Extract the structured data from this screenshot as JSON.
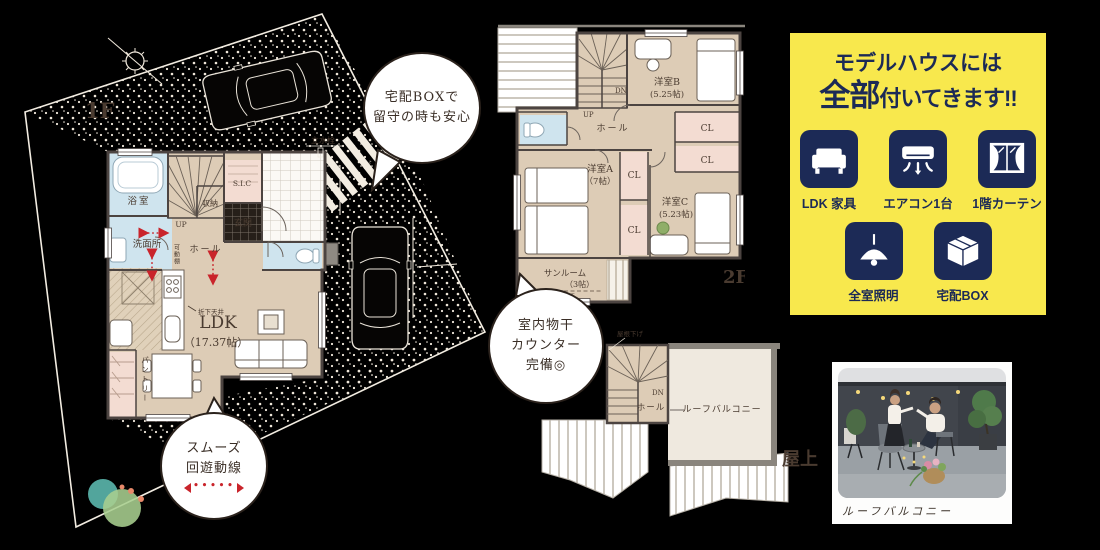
{
  "colors": {
    "background": "#000000",
    "floor_beige": "#ddccb6",
    "wet_area_blue": "#cfe4ee",
    "closet_pink": "#f3dcd2",
    "wall": "#4c4441",
    "site_line": "#f2ece1",
    "flow_arrow_red": "#c9242b",
    "promo_yellow": "#f8e84d",
    "promo_navy": "#1c2a56"
  },
  "floor1": {
    "label": "1F",
    "rooms": {
      "bath": "浴室",
      "washroom": "洗面所",
      "storage": "収納",
      "sic": "S.I.C",
      "entrance": "玄関",
      "hall": "ホール",
      "ldk": "LDK",
      "ldk_size": "（17.37帖）",
      "pantry": "パントリー"
    },
    "notes": {
      "up": "UP",
      "movable_shelf": "可動棚",
      "lowered_ceiling": "折下天井",
      "water_tap": "立水栓"
    }
  },
  "floor2": {
    "label": "2F",
    "rooms": {
      "bedroom_b": "洋室B",
      "bedroom_b_size": "(5.25帖)",
      "bedroom_a": "洋室A",
      "bedroom_a_size": "（7帖）",
      "bedroom_c": "洋室C",
      "bedroom_c_size": "(5.23帖)",
      "hall": "ホール",
      "cl": "CL",
      "sunroom": "サンルーム",
      "sunroom_size": "（3帖）",
      "drying": "室内物干"
    },
    "notes": {
      "dn": "DN",
      "up": "UP"
    }
  },
  "roof": {
    "label": "屋上",
    "rooms": {
      "hall": "ホール",
      "balcony": "ルーフバルコニー"
    },
    "notes": {
      "dn": "DN",
      "roof_down": "屋根下げ"
    }
  },
  "bubbles": {
    "delivery": {
      "l1": "宅配BOXで",
      "l2": "留守の時も安心"
    },
    "drying": {
      "l1": "室内物干",
      "l2": "カウンター",
      "l3": "完備◎"
    },
    "smooth": {
      "l1": "スムーズ",
      "l2": "回遊動線",
      "dots": "•••••"
    }
  },
  "promo": {
    "title1": "モデルハウスには",
    "title2a": "全部",
    "title2b": "付いてきます!!",
    "items": [
      {
        "icon": "sofa",
        "label": "LDK 家具"
      },
      {
        "icon": "aircon",
        "label": "エアコン1台"
      },
      {
        "icon": "curtain",
        "label": "1階カーテン"
      },
      {
        "icon": "ceiling-light",
        "label": "全室照明"
      },
      {
        "icon": "delivery-box",
        "label": "宅配BOX"
      }
    ]
  },
  "photo": {
    "caption": "ルーフバルコニー"
  }
}
